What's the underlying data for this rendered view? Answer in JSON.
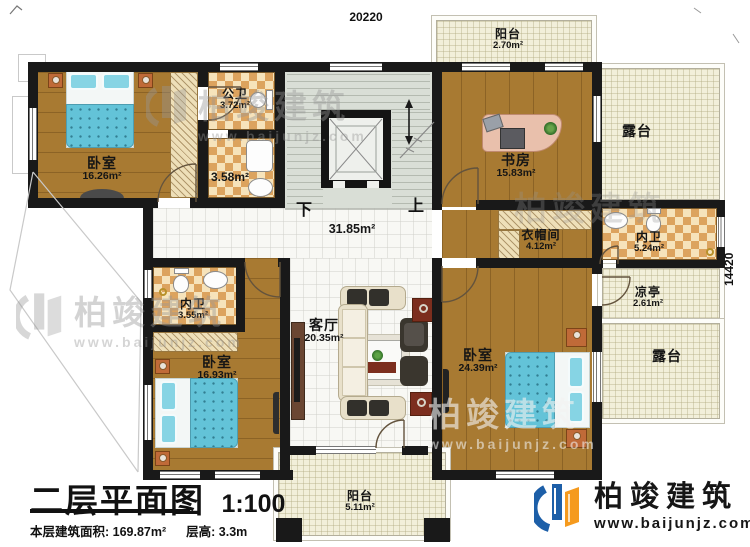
{
  "dimensions": {
    "width_top": "20220",
    "height_right": "14420"
  },
  "stairs": {
    "down_label": "下",
    "up_label": "上"
  },
  "rooms": {
    "bedroom_top_left": {
      "name": "卧室",
      "area": "16.26m²"
    },
    "public_bath": {
      "name": "公卫",
      "area": "3.72m²"
    },
    "middle_bath": {
      "area": "3.58m²"
    },
    "hall": {
      "area": "31.85m²"
    },
    "study": {
      "name": "书房",
      "area": "15.83m²"
    },
    "top_balcony": {
      "name": "阳台",
      "area": "2.70m²"
    },
    "top_terrace": {
      "name": "露台"
    },
    "cloakroom": {
      "name": "衣帽间",
      "area": "4.12m²"
    },
    "right_inner_bath": {
      "name": "内卫",
      "area": "5.24m²"
    },
    "left_inner_bath": {
      "name": "内卫",
      "area": "3.55m²"
    },
    "bedroom_bottom_left": {
      "name": "卧室",
      "area": "16.93m²"
    },
    "living_room": {
      "name": "客厅",
      "area": "20.35m²"
    },
    "bedroom_bottom_right": {
      "name": "卧室",
      "area": "24.39m²"
    },
    "pavilion": {
      "name": "凉亭",
      "area": "2.61m²"
    },
    "bottom_terrace": {
      "name": "露台"
    },
    "bottom_balcony": {
      "name": "阳台",
      "area": "5.11m²"
    }
  },
  "title_block": {
    "title": "二层平面图",
    "scale": "1:100",
    "floor_area": "本层建筑面积: 169.87m²",
    "floor_height": "层高: 3.3m"
  },
  "brand": {
    "name": "柏竣建筑",
    "website": "www.baijunjz.com"
  },
  "colors": {
    "wall": "#191919",
    "wood": "#a87a32",
    "checker": "#dca35e",
    "terrace": "#f2efda",
    "bed": "#63c3d8",
    "logo_blue": "#1d5fa8",
    "logo_orange": "#f59a1e"
  }
}
